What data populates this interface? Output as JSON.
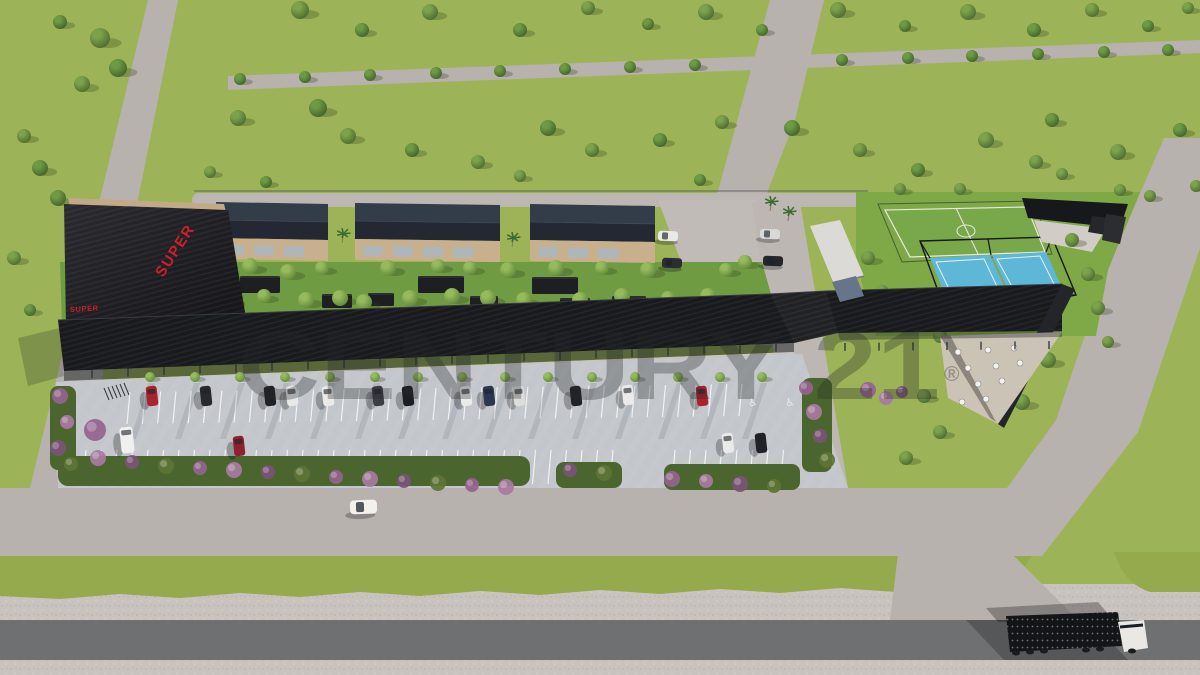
{
  "watermark": {
    "text": "CENTURY 21",
    "reg": "®",
    "color": "#26272a",
    "opacity": 0.31
  },
  "signs": {
    "roof": "SUPER",
    "wall": "SUPER",
    "color": "#c8202c"
  },
  "parking": {
    "disabled_glyph": "♿",
    "lines": [
      {
        "x0": 130,
        "dx": 15.3,
        "n": 41,
        "y0": 392,
        "k": 0.013,
        "len": 32,
        "skip": [
          0,
          0
        ]
      },
      {
        "x0": 86,
        "dx": 15.5,
        "n": 46,
        "y0": 450,
        "k": 0,
        "len": 34,
        "skip": [
          616,
          668
        ]
      }
    ]
  },
  "palette": {
    "grass": "#9cb457",
    "dev_grass": "#7fa846",
    "garden": "#6f9c42",
    "road_light": "#b8b2af",
    "concrete": "#c3c7cb",
    "gravel": "#c9c3bf",
    "highway": "#6f7071",
    "roof_black": "#191a1d",
    "facade_tan": "#c9b08d",
    "pitch_green": "#79a84a",
    "padel_blue": "#5fb7d8",
    "hedge": "#4a662e",
    "sign_red": "#c8202c",
    "olive_strip": "#95aa4d",
    "bush": [
      "#94638f",
      "#a87aa2",
      "#7b527a",
      "#5d7434"
    ]
  },
  "scene": {
    "trees": {
      "field_a": [
        [
          300,
          10,
          9
        ],
        [
          430,
          12,
          8
        ],
        [
          588,
          8,
          7
        ],
        [
          706,
          12,
          8
        ],
        [
          838,
          10,
          8
        ],
        [
          968,
          12,
          8
        ],
        [
          1092,
          10,
          7
        ],
        [
          1188,
          8,
          6
        ],
        [
          100,
          38,
          10
        ],
        [
          82,
          84,
          8
        ],
        [
          24,
          136,
          7
        ],
        [
          14,
          258,
          7
        ],
        [
          238,
          118,
          8
        ],
        [
          348,
          136,
          8
        ],
        [
          478,
          162,
          7
        ],
        [
          592,
          150,
          7
        ],
        [
          722,
          122,
          7
        ],
        [
          860,
          150,
          7
        ],
        [
          986,
          140,
          8
        ],
        [
          1118,
          152,
          8
        ],
        [
          1196,
          186,
          6
        ],
        [
          210,
          172,
          6
        ],
        [
          520,
          176,
          6
        ],
        [
          1150,
          196,
          6
        ]
      ],
      "field_b": [
        [
          362,
          30,
          7
        ],
        [
          520,
          30,
          7
        ],
        [
          648,
          24,
          6
        ],
        [
          762,
          30,
          6
        ],
        [
          905,
          26,
          6
        ],
        [
          1034,
          30,
          7
        ],
        [
          1148,
          26,
          6
        ],
        [
          118,
          68,
          9
        ],
        [
          60,
          22,
          7
        ],
        [
          40,
          168,
          8
        ],
        [
          30,
          310,
          6
        ],
        [
          318,
          108,
          9
        ],
        [
          412,
          150,
          7
        ],
        [
          548,
          128,
          8
        ],
        [
          660,
          140,
          7
        ],
        [
          792,
          128,
          8
        ],
        [
          918,
          170,
          7
        ],
        [
          1052,
          120,
          7
        ],
        [
          1180,
          130,
          7
        ],
        [
          266,
          182,
          6
        ],
        [
          700,
          180,
          6
        ],
        [
          58,
          198,
          8
        ]
      ],
      "path": [
        [
          240,
          79,
          6
        ],
        [
          305,
          77,
          6
        ],
        [
          370,
          75,
          6
        ],
        [
          436,
          73,
          6
        ],
        [
          500,
          71,
          6
        ],
        [
          565,
          69,
          6
        ],
        [
          630,
          67,
          6
        ],
        [
          695,
          65,
          6
        ],
        [
          842,
          60,
          6
        ],
        [
          908,
          58,
          6
        ],
        [
          972,
          56,
          6
        ],
        [
          1038,
          54,
          6
        ],
        [
          1104,
          52,
          6
        ],
        [
          1168,
          50,
          6
        ]
      ],
      "garden": [
        [
          200,
          272,
          8
        ],
        [
          226,
          300,
          9
        ],
        [
          250,
          266,
          8
        ],
        [
          264,
          296,
          7
        ],
        [
          288,
          272,
          8
        ],
        [
          306,
          300,
          8
        ],
        [
          322,
          268,
          7
        ],
        [
          340,
          298,
          8
        ],
        [
          364,
          302,
          8
        ],
        [
          388,
          268,
          8
        ],
        [
          410,
          298,
          8
        ],
        [
          438,
          266,
          7
        ],
        [
          452,
          296,
          8
        ],
        [
          470,
          268,
          7
        ],
        [
          488,
          298,
          8
        ],
        [
          508,
          270,
          8
        ],
        [
          524,
          300,
          8
        ],
        [
          556,
          268,
          8
        ],
        [
          580,
          300,
          8
        ],
        [
          602,
          268,
          7
        ],
        [
          622,
          296,
          8
        ],
        [
          648,
          270,
          8
        ],
        [
          668,
          298,
          7
        ],
        [
          690,
          320,
          7
        ],
        [
          708,
          296,
          8
        ],
        [
          726,
          270,
          7
        ],
        [
          745,
          262,
          7
        ],
        [
          752,
          308,
          7
        ]
      ],
      "sports": [
        [
          868,
          258,
          7
        ],
        [
          882,
          292,
          7
        ],
        [
          896,
          318,
          6
        ],
        [
          940,
          336,
          7
        ],
        [
          958,
          370,
          8
        ],
        [
          924,
          396,
          7
        ],
        [
          940,
          432,
          7
        ],
        [
          906,
          458,
          7
        ],
        [
          1048,
          360,
          8
        ],
        [
          1022,
          402,
          8
        ],
        [
          1072,
          240,
          7
        ],
        [
          1088,
          274,
          7
        ],
        [
          1098,
          308,
          7
        ],
        [
          1108,
          342,
          6
        ],
        [
          1036,
          162,
          7
        ],
        [
          1062,
          174,
          6
        ],
        [
          900,
          189,
          6
        ],
        [
          960,
          189,
          6
        ],
        [
          1120,
          190,
          6
        ]
      ],
      "sidewalk": [
        [
          150,
          377,
          5
        ],
        [
          195,
          377,
          5
        ],
        [
          240,
          377,
          5
        ],
        [
          285,
          377,
          5
        ],
        [
          330,
          377,
          5
        ],
        [
          375,
          377,
          5
        ],
        [
          418,
          377,
          5
        ],
        [
          462,
          377,
          5
        ],
        [
          505,
          377,
          5
        ],
        [
          548,
          377,
          5
        ],
        [
          592,
          377,
          5
        ],
        [
          635,
          377,
          5
        ],
        [
          678,
          377,
          5
        ],
        [
          720,
          377,
          5
        ],
        [
          762,
          377,
          5
        ]
      ]
    },
    "palms": [
      [
        342,
        234
      ],
      [
        512,
        238
      ],
      [
        770,
        202
      ],
      [
        788,
        212
      ]
    ],
    "bushes": [
      [
        60,
        396,
        8
      ],
      [
        67,
        422,
        7
      ],
      [
        58,
        448,
        8
      ],
      [
        71,
        464,
        7
      ],
      [
        95,
        430,
        11
      ],
      [
        98,
        458,
        8
      ],
      [
        132,
        462,
        7
      ],
      [
        166,
        466,
        8
      ],
      [
        200,
        468,
        7
      ],
      [
        234,
        470,
        8
      ],
      [
        268,
        472,
        7
      ],
      [
        302,
        474,
        8
      ],
      [
        336,
        477,
        7
      ],
      [
        370,
        479,
        8
      ],
      [
        404,
        481,
        7
      ],
      [
        438,
        483,
        8
      ],
      [
        472,
        485,
        7
      ],
      [
        506,
        487,
        8
      ],
      [
        570,
        470,
        7
      ],
      [
        604,
        473,
        8
      ],
      [
        672,
        479,
        8
      ],
      [
        706,
        481,
        7
      ],
      [
        740,
        484,
        8
      ],
      [
        774,
        486,
        7
      ],
      [
        806,
        388,
        7
      ],
      [
        814,
        412,
        8
      ],
      [
        820,
        436,
        7
      ],
      [
        827,
        460,
        8
      ],
      [
        868,
        390,
        8
      ],
      [
        886,
        398,
        7
      ],
      [
        902,
        392,
        6
      ]
    ],
    "cars": {
      "row1": [
        [
          152,
          396,
          "#a8232e"
        ],
        [
          206,
          396,
          "#27292e"
        ],
        [
          270,
          396,
          "#202227"
        ],
        [
          292,
          396,
          "#e8e8e6"
        ],
        [
          328,
          396,
          "#eceae7"
        ],
        [
          378,
          396,
          "#3b3e45"
        ],
        [
          408,
          396,
          "#1c1e23"
        ],
        [
          466,
          396,
          "#ebebe9"
        ],
        [
          489,
          396,
          "#2c3850"
        ],
        [
          519,
          396,
          "#dedddb"
        ],
        [
          576,
          396,
          "#212328"
        ],
        [
          628,
          395,
          "#ecebe9"
        ],
        [
          702,
          396,
          "#a8232e"
        ]
      ],
      "row2": [
        [
          127,
          440,
          "#f1f0ed",
          "van"
        ],
        [
          239,
          446,
          "#8e2130"
        ],
        [
          728,
          443,
          "#eaeae8"
        ],
        [
          761,
          443,
          "#202227"
        ]
      ],
      "drive": [
        [
          668,
          236,
          "#e9e9e7"
        ],
        [
          672,
          263,
          "#2b2d32"
        ],
        [
          770,
          234,
          "#d9d9d7"
        ],
        [
          773,
          261,
          "#24262b"
        ]
      ]
    },
    "sheds": [
      [
        186,
        300,
        34,
        16
      ],
      [
        240,
        276,
        40,
        17
      ],
      [
        322,
        294,
        30,
        14
      ],
      [
        368,
        293,
        26,
        13
      ],
      [
        418,
        276,
        46,
        17
      ],
      [
        470,
        296,
        28,
        13
      ],
      [
        532,
        277,
        46,
        17
      ],
      [
        560,
        298,
        30,
        14
      ],
      [
        612,
        296,
        34,
        15
      ],
      [
        700,
        314,
        26,
        13
      ]
    ],
    "tables": [
      [
        958,
        352
      ],
      [
        988,
        350
      ],
      [
        1014,
        348
      ],
      [
        968,
        368
      ],
      [
        996,
        366
      ],
      [
        1020,
        363
      ],
      [
        978,
        384
      ],
      [
        1002,
        381
      ],
      [
        962,
        402
      ],
      [
        986,
        399
      ]
    ],
    "posts": [
      {
        "x0": 92,
        "dx": 36,
        "n": 20,
        "a": 371,
        "b": 0.0384,
        "xr": 64,
        "h": 8
      },
      {
        "x0": 845,
        "dx": 34,
        "n": 7,
        "a": 343,
        "b": 0.009,
        "xr": 838,
        "h": 8
      }
    ],
    "buildings": [
      [
        216,
        328,
        202
      ],
      [
        355,
        500,
        203
      ],
      [
        530,
        655,
        204
      ]
    ]
  }
}
